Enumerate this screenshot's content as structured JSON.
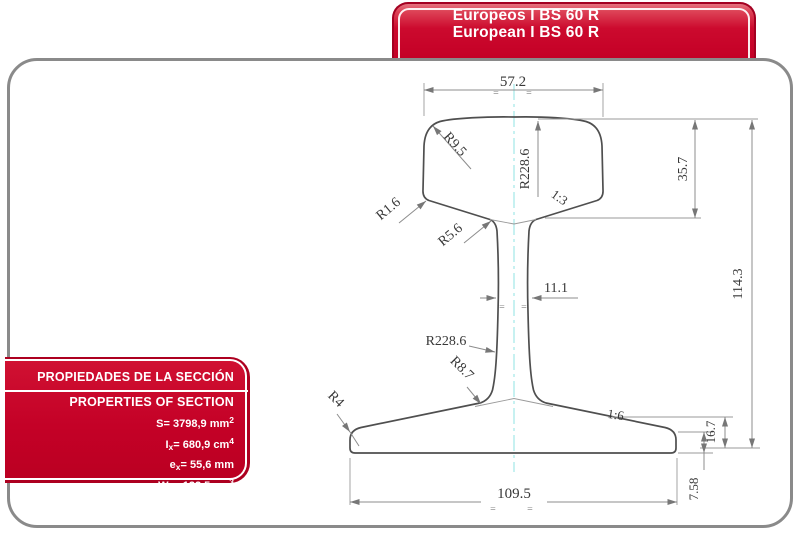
{
  "header_banner": {
    "title_es": "Europeos I BS 60 R",
    "title_en": "European I BS 60 R"
  },
  "properties_box": {
    "title_es": "PROPIEDADES DE LA SECCIÓN",
    "title_en": "PROPERTIES OF SECTION",
    "rows": [
      {
        "sym": "S",
        "sub": "",
        "eq": "=",
        "val": " 3798,9 mm",
        "sup": "2"
      },
      {
        "sym": "I",
        "sub": "x",
        "eq": "=",
        "val": " 680,9 cm",
        "sup": "4"
      },
      {
        "sym": "e",
        "sub": "x",
        "eq": "=",
        "val": " 55,6 mm",
        "sup": ""
      },
      {
        "sym": "W",
        "sub": "x",
        "eq": "=",
        "val": " 122,5 cm",
        "sup": "3"
      }
    ]
  },
  "drawing": {
    "labels": {
      "head_width": "57.2",
      "head_corner_radius": "R9.5",
      "crown_radius": "R228.6",
      "head_side_slope": "1:3",
      "head_depth": "35.7",
      "total_height": "114.3",
      "underhead_corner_radius": "R1.6",
      "web_top_fillet_radius": "R5.6",
      "web_thickness": "11.1",
      "web_face_radius": "R228.6",
      "foot_fillet_radius": "R8.7",
      "foot_edge_radius": "R4",
      "foot_slope": "1:6",
      "foot_thickness": "16.7",
      "foot_width": "109.5",
      "foot_edge_thickness": "7.58",
      "center_mark": "="
    },
    "colors": {
      "outline": "#4f4f4f",
      "dimension_line": "#8c8c8c",
      "extension_line": "#9a9a9a",
      "label_text": "#383838",
      "centerline": "#8fe3e3",
      "arrow": "#777777"
    }
  },
  "theme": {
    "accent_red": "#c40026",
    "accent_red_dark": "#a30021",
    "frame_gray": "#8a8a8a",
    "text_white": "#ffffff"
  }
}
